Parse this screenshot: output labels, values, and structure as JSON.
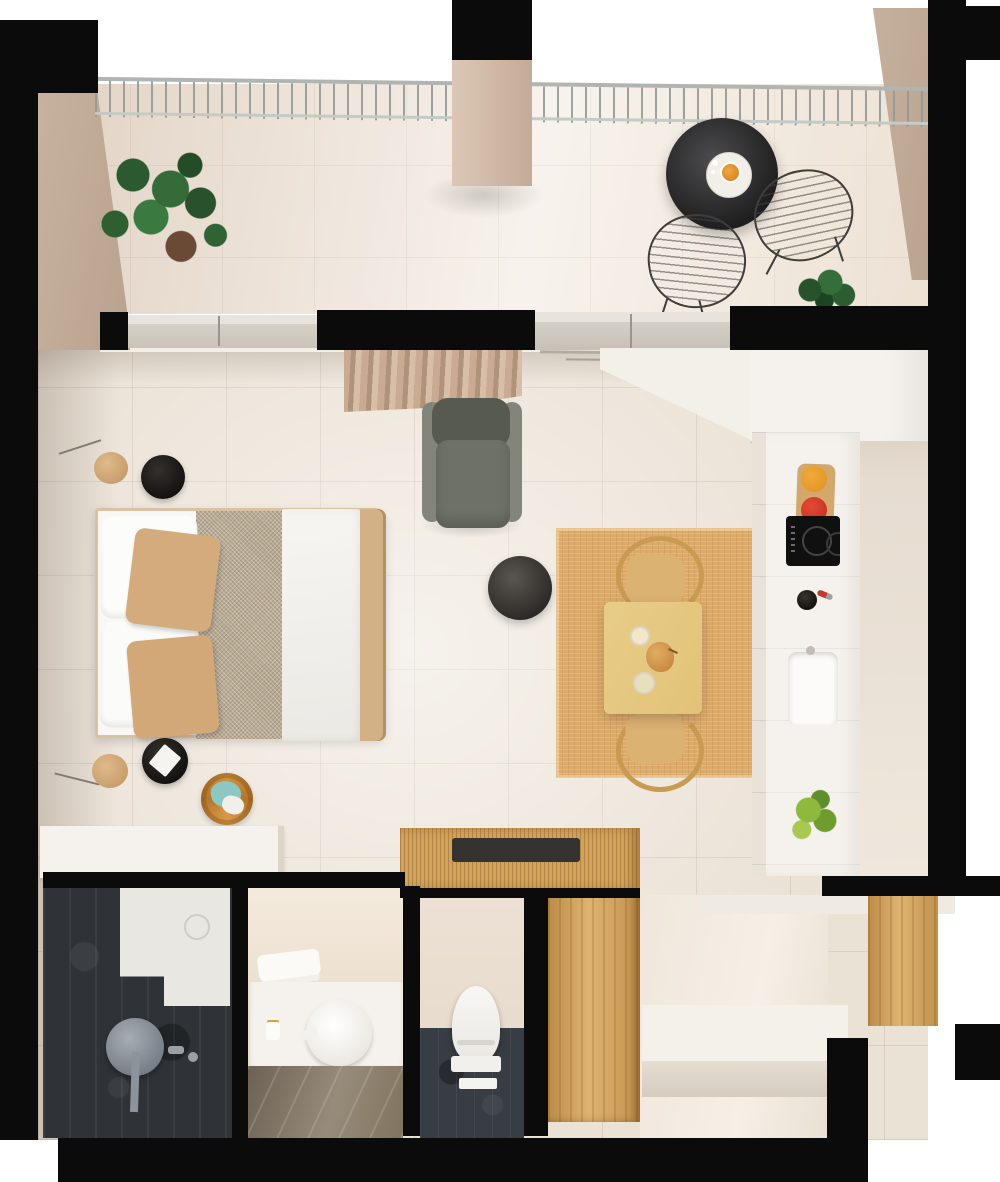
{
  "meta": {
    "label": "3D rendered top-down floor plan of a studio apartment with balcony, combined bedroom and living area, kitchen column, dining corner, shower room, vanity room, WC and entry wardrobe nook"
  },
  "colors": {
    "wall": "#0b0b0b",
    "floor": "#ebe2d6",
    "balcony-floor": "#eee3d7",
    "tan-wall": "#c7b2a0",
    "white-cab": "#f5f2ed",
    "wood": "#d3a35b",
    "wood-light": "#e7cd88",
    "rug": "#dcab6b",
    "slate": "#2f3338",
    "slate-floor": "#383d43",
    "chair-gray": "#6e7165",
    "charcoal": "#2b2927",
    "accent-orange": "#e0921e",
    "accent-red": "#c9271b",
    "accent-green": "#9fb42c",
    "teal": "#8cc7c2",
    "plant-green": "#2f6234",
    "vanity-floor": "#857867",
    "duvet": "#f6f5f2",
    "blanket": "#b9aa93",
    "tan-pillow": "#d4ab7c",
    "railing": "#b0b5b1"
  },
  "rooms": [
    {
      "name": "balcony",
      "furniture": [
        "railing",
        "chimney-column",
        "potted-plant",
        "bistro-table",
        "coffee-cup",
        "wire-chair-left",
        "wire-chair-right",
        "small-plant"
      ]
    },
    {
      "name": "living-bedroom",
      "furniture": [
        "double-bed",
        "white-pillows",
        "tan-pillows",
        "textured-blanket",
        "white-duvet",
        "nightstand-top",
        "nightstand-bottom",
        "floor-lamp-top",
        "floor-lamp-bottom",
        "laundry-basket",
        "armchair",
        "round-pouf",
        "curtains",
        "low-dresser"
      ]
    },
    {
      "name": "dining-area",
      "furniture": [
        "jute-rug",
        "square-table",
        "wood-chair-top",
        "wood-chair-bottom",
        "pear",
        "drinking-glasses"
      ]
    },
    {
      "name": "kitchen",
      "furniture": [
        "upper-cabinets",
        "tall-counter",
        "induction-cooktop",
        "fruit-tray",
        "kitchen-sink",
        "bottle",
        "herb-plant"
      ]
    },
    {
      "name": "shower-room",
      "furniture": [
        "shower-tray",
        "floor-drain",
        "rain-shower-head",
        "mixer-fixtures"
      ]
    },
    {
      "name": "vanity-room",
      "furniture": [
        "vanity-counter",
        "washbasin",
        "towels",
        "candle",
        "marble-floor"
      ]
    },
    {
      "name": "wc",
      "furniture": [
        "toilet",
        "toilet-mat",
        "dark-tile-floor"
      ]
    },
    {
      "name": "entry-nook",
      "furniture": [
        "storage-cube-top",
        "serving-tray",
        "wardrobe-panel",
        "hallway-floor",
        "entry-bench",
        "wood-back-panel"
      ]
    }
  ]
}
